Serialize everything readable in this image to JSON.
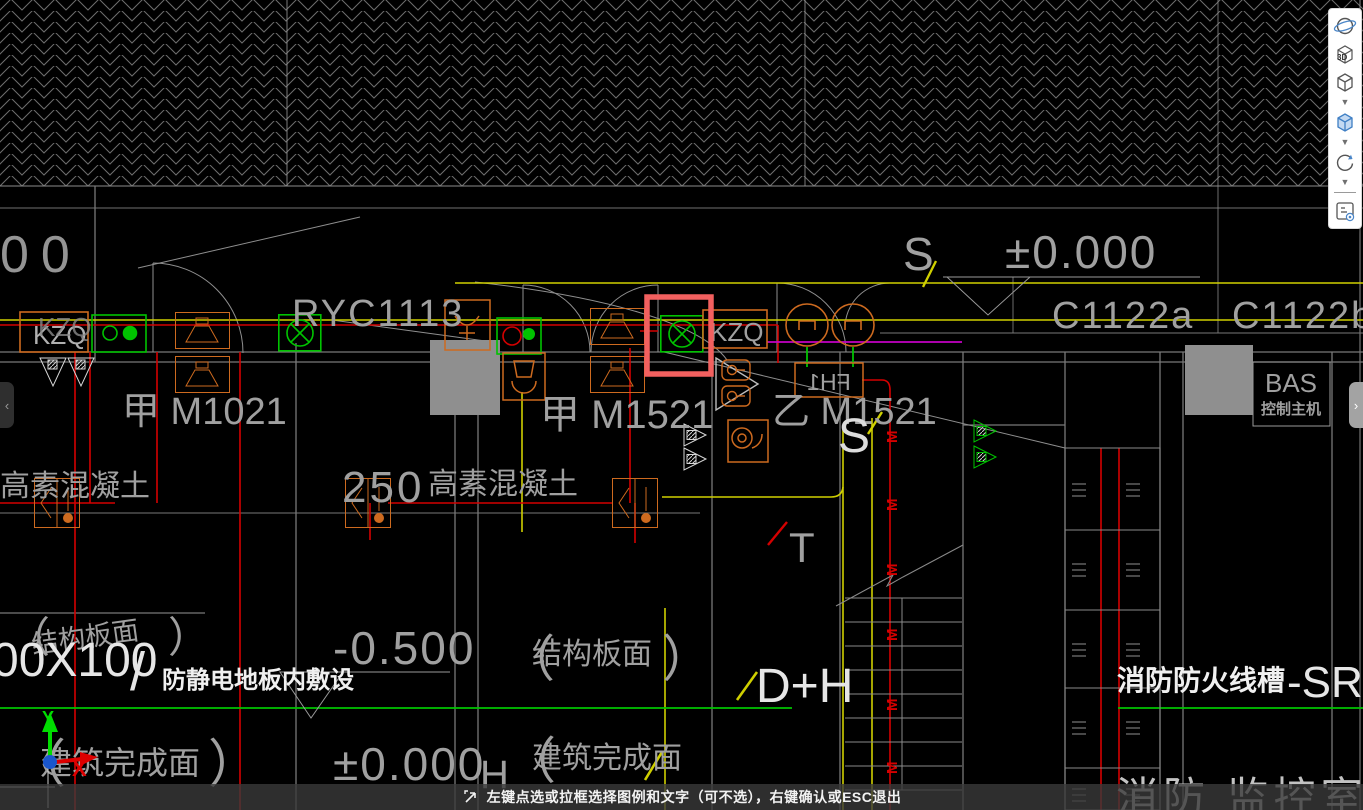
{
  "app": {
    "status_hint": "左键点选或拉框选择图例和文字（可不选），右键确认或ESC退出",
    "tab_left": "‹",
    "tab_right": "›"
  },
  "toolbar": {
    "view3d_label": "3D",
    "items": [
      "orbit",
      "3d-view",
      "cube-view",
      "cube-view-options",
      "solid-cube-view",
      "solid-cube-options",
      "rotate-view",
      "rotate-options",
      "sheet-visibility"
    ]
  },
  "drawing": {
    "labels": {
      "partial_number": "00",
      "kzq_left": "KZQ",
      "kzq_mid": "KZQ",
      "ryc": "RYC1113",
      "s_top": "S",
      "s_mid": "S",
      "level_top": "±0.000",
      "level_bottom": "±0.000",
      "level_neg": "-0.500",
      "c1122a": "C1122a",
      "c1122b": "C1122b",
      "door_a_m1021": "甲 M1021",
      "door_a_m1521": "甲 M1521",
      "door_b_m1521": "乙 M1521",
      "fh1": "FH1",
      "concrete_left": "高素混凝土",
      "concrete_mid": "高素混凝土",
      "dim_250": "250",
      "t_marker": "T",
      "m_marker": "M",
      "h_marker": "H",
      "dh_marker": "D+H",
      "paren_open": "（",
      "paren_close": "）",
      "struct_left": "结构板面",
      "struct_mid": "结构板面",
      "finish_left": "建筑完成面",
      "finish_mid": "建筑完成面",
      "duct_size": "00X100",
      "duct_slash": "/",
      "antistatic": "防静电地板内敷设",
      "fire_tray_cn": "消防防火线槽",
      "fire_tray_code": "-SR-200X10",
      "bas": "BAS",
      "bas_sub": "控制主机",
      "monitor_room": "消防 监控室",
      "ucs_x": "X",
      "ucs_y": "Y"
    },
    "colors": {
      "highlight_box": "#f2605f",
      "symbol_orange": "#cd6a1f",
      "symbol_green": "#00c300",
      "wire_red": "#d40000",
      "wire_yellow": "#cfcf00",
      "wire_magenta": "#c400c4",
      "wire_green": "#00c400",
      "text_gray": "#a0a0a0",
      "text_white": "#ececec"
    }
  }
}
